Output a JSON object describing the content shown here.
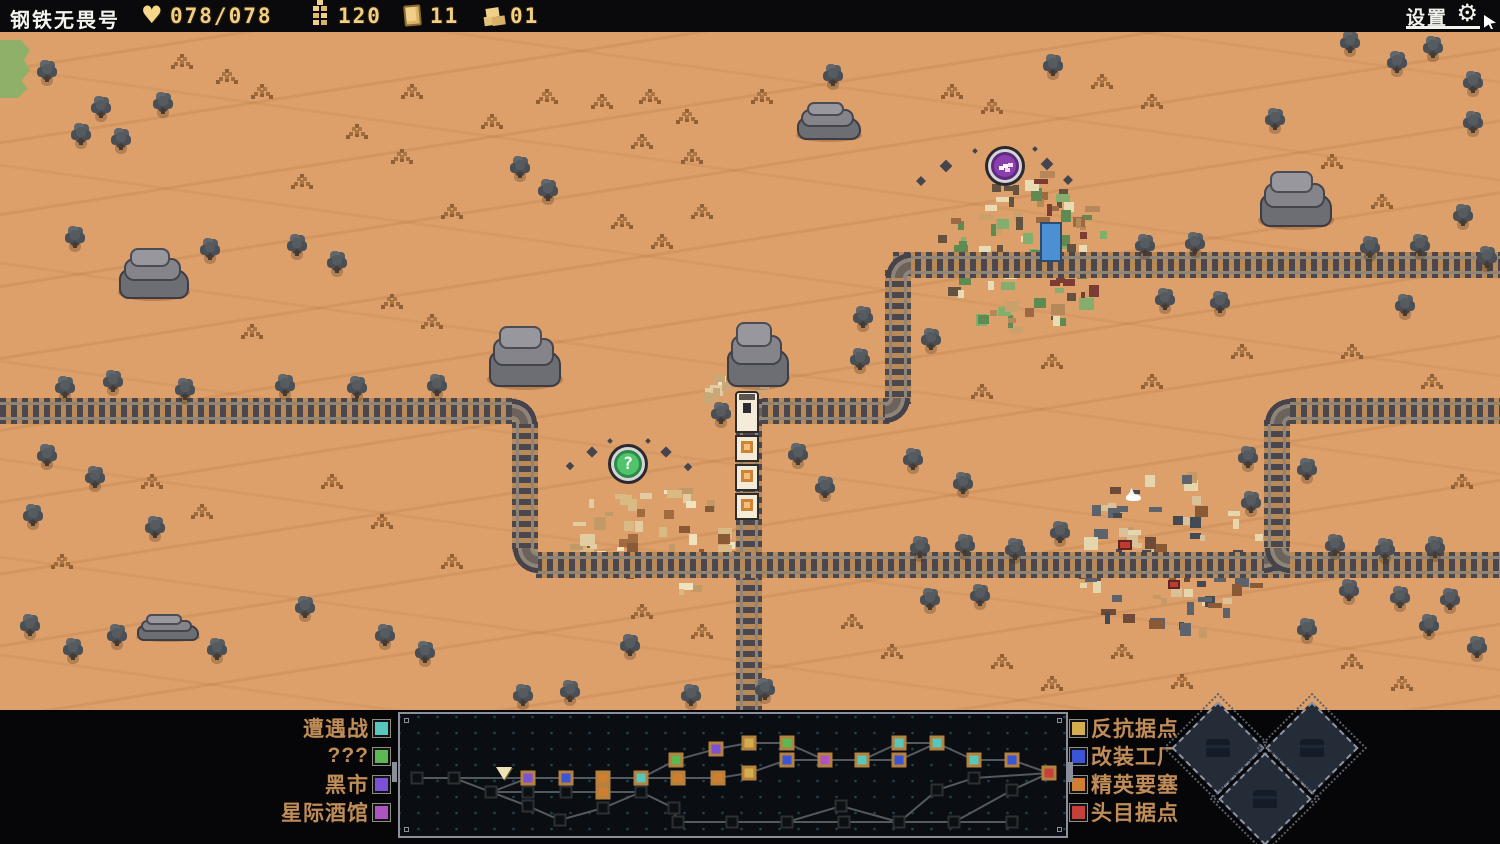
{
  "top_bar": {
    "title": "钢铁无畏号",
    "hp": {
      "icon": "heart-icon",
      "value": "078/078"
    },
    "resources": [
      {
        "icon": "ammo-icon",
        "value": "120"
      },
      {
        "icon": "plate-icon",
        "value": "11"
      },
      {
        "icon": "scrap-icon",
        "value": "01"
      }
    ],
    "settings_label": "设置"
  },
  "map": {
    "green_patch": {
      "x": 0,
      "y": 40,
      "w": 30,
      "h": 58
    },
    "tracks": [
      {
        "dir": "h",
        "x": 893,
        "y": 252,
        "len": 607
      },
      {
        "dir": "v",
        "x": 885,
        "y": 270,
        "len": 134
      },
      {
        "dir": "h",
        "x": 762,
        "y": 398,
        "len": 128
      },
      {
        "dir": "v",
        "x": 736,
        "y": 420,
        "len": 290
      },
      {
        "dir": "h",
        "x": 0,
        "y": 398,
        "len": 516
      },
      {
        "dir": "v",
        "x": 512,
        "y": 422,
        "len": 130
      },
      {
        "dir": "h",
        "x": 536,
        "y": 552,
        "len": 964
      },
      {
        "dir": "v",
        "x": 1264,
        "y": 420,
        "len": 134
      },
      {
        "dir": "h",
        "x": 1290,
        "y": 398,
        "len": 210
      }
    ],
    "corners": [
      {
        "x": 885,
        "y": 252,
        "anchor": "br"
      },
      {
        "x": 885,
        "y": 398,
        "anchor": "tl"
      },
      {
        "x": 736,
        "y": 398,
        "anchor": "br"
      },
      {
        "x": 512,
        "y": 398,
        "anchor": "bl"
      },
      {
        "x": 512,
        "y": 548,
        "anchor": "tr"
      },
      {
        "x": 1264,
        "y": 398,
        "anchor": "br"
      },
      {
        "x": 1264,
        "y": 548,
        "anchor": "tl"
      },
      {
        "x": 1264,
        "y": 548,
        "anchor": "tr"
      }
    ],
    "rocks": [
      {
        "x": 118,
        "y": 243,
        "w": 72,
        "h": 58
      },
      {
        "x": 487,
        "y": 320,
        "w": 76,
        "h": 70
      },
      {
        "x": 726,
        "y": 316,
        "w": 64,
        "h": 74
      },
      {
        "x": 796,
        "y": 98,
        "w": 66,
        "h": 44
      },
      {
        "x": 1258,
        "y": 166,
        "w": 76,
        "h": 64
      },
      {
        "x": 136,
        "y": 612,
        "w": 64,
        "h": 30
      }
    ],
    "bushes": [
      [
        42,
        64
      ],
      [
        96,
        100
      ],
      [
        158,
        96
      ],
      [
        76,
        127
      ],
      [
        116,
        132
      ],
      [
        828,
        68
      ],
      [
        1048,
        58
      ],
      [
        1345,
        35
      ],
      [
        1392,
        55
      ],
      [
        1428,
        40
      ],
      [
        1468,
        75
      ],
      [
        1468,
        115
      ],
      [
        1270,
        112
      ],
      [
        1458,
        208
      ],
      [
        1482,
        250
      ],
      [
        70,
        230
      ],
      [
        205,
        242
      ],
      [
        292,
        238
      ],
      [
        332,
        255
      ],
      [
        515,
        160
      ],
      [
        543,
        183
      ],
      [
        858,
        310
      ],
      [
        855,
        352
      ],
      [
        926,
        332
      ],
      [
        60,
        380
      ],
      [
        108,
        374
      ],
      [
        180,
        382
      ],
      [
        280,
        378
      ],
      [
        352,
        380
      ],
      [
        432,
        378
      ],
      [
        42,
        448
      ],
      [
        90,
        470
      ],
      [
        28,
        508
      ],
      [
        150,
        520
      ],
      [
        716,
        406
      ],
      [
        793,
        447
      ],
      [
        820,
        480
      ],
      [
        908,
        452
      ],
      [
        958,
        476
      ],
      [
        1243,
        450
      ],
      [
        1246,
        495
      ],
      [
        1302,
        462
      ],
      [
        915,
        540
      ],
      [
        960,
        538
      ],
      [
        1010,
        542
      ],
      [
        1330,
        538
      ],
      [
        1380,
        542
      ],
      [
        1430,
        540
      ],
      [
        925,
        592
      ],
      [
        975,
        588
      ],
      [
        1395,
        590
      ],
      [
        1445,
        592
      ],
      [
        1160,
        292
      ],
      [
        1215,
        295
      ],
      [
        1400,
        298
      ],
      [
        1140,
        238
      ],
      [
        1190,
        236
      ],
      [
        1365,
        240
      ],
      [
        1415,
        238
      ],
      [
        25,
        618
      ],
      [
        68,
        642
      ],
      [
        112,
        628
      ],
      [
        212,
        642
      ],
      [
        380,
        628
      ],
      [
        420,
        645
      ],
      [
        518,
        688
      ],
      [
        565,
        684
      ],
      [
        625,
        638
      ],
      [
        686,
        688
      ],
      [
        1302,
        622
      ],
      [
        1344,
        583
      ],
      [
        1424,
        618
      ],
      [
        1472,
        640
      ],
      [
        1055,
        525
      ],
      [
        300,
        600
      ],
      [
        760,
        682
      ]
    ],
    "grass": [
      [
        600,
        100
      ],
      [
        648,
        95
      ],
      [
        685,
        115
      ],
      [
        640,
        140
      ],
      [
        690,
        155
      ],
      [
        225,
        75
      ],
      [
        260,
        90
      ],
      [
        180,
        60
      ],
      [
        760,
        95
      ],
      [
        950,
        90
      ],
      [
        990,
        105
      ],
      [
        1100,
        80
      ],
      [
        1150,
        100
      ],
      [
        355,
        130
      ],
      [
        400,
        155
      ],
      [
        300,
        180
      ],
      [
        450,
        210
      ],
      [
        620,
        220
      ],
      [
        660,
        240
      ],
      [
        700,
        210
      ],
      [
        390,
        300
      ],
      [
        430,
        320
      ],
      [
        250,
        330
      ],
      [
        150,
        480
      ],
      [
        200,
        510
      ],
      [
        60,
        560
      ],
      [
        330,
        480
      ],
      [
        380,
        520
      ],
      [
        450,
        560
      ],
      [
        640,
        610
      ],
      [
        700,
        630
      ],
      [
        850,
        620
      ],
      [
        890,
        650
      ],
      [
        1000,
        660
      ],
      [
        1050,
        682
      ],
      [
        1120,
        650
      ],
      [
        1180,
        680
      ],
      [
        1350,
        660
      ],
      [
        1400,
        682
      ],
      [
        1460,
        480
      ],
      [
        1430,
        380
      ],
      [
        1350,
        350
      ],
      [
        1240,
        350
      ],
      [
        1150,
        380
      ],
      [
        1050,
        360
      ],
      [
        980,
        390
      ],
      [
        1330,
        160
      ],
      [
        1380,
        200
      ],
      [
        1430,
        260
      ],
      [
        545,
        95
      ],
      [
        490,
        120
      ],
      [
        410,
        90
      ]
    ],
    "settlements": [
      {
        "name": "town",
        "x": 935,
        "y": 168,
        "w": 170,
        "h": 160,
        "seed": 7,
        "blocks": 95,
        "palette": [
          "#84ae6d",
          "#5f8a52",
          "#caa06b",
          "#e9dcb4",
          "#7c3c34",
          "#9a6a45",
          "#63523f",
          "#b5885a"
        ]
      },
      {
        "name": "ruins",
        "x": 565,
        "y": 480,
        "w": 165,
        "h": 115,
        "seed": 11,
        "blocks": 60,
        "palette": [
          "#efe2bd",
          "#e2cda2",
          "#d9ba84",
          "#a06b3f",
          "#c29a68",
          "#8a5a36"
        ]
      },
      {
        "name": "outpost",
        "x": 1072,
        "y": 468,
        "w": 190,
        "h": 165,
        "seed": 23,
        "blocks": 90,
        "palette": [
          "#5c636d",
          "#434a54",
          "#c49a66",
          "#8a5a36",
          "#d9c29a",
          "#6e4a38",
          "#e6d6ae"
        ]
      },
      {
        "name": "debris",
        "x": 692,
        "y": 366,
        "w": 74,
        "h": 34,
        "seed": 3,
        "blocks": 14,
        "palette": [
          "#efe2bd",
          "#e2cda2",
          "#c8a878"
        ]
      }
    ],
    "features": [
      {
        "type": "water-tank",
        "x": 1040,
        "y": 222,
        "w": 22,
        "h": 40,
        "color": "#4a90d2"
      },
      {
        "type": "bird",
        "x": 1126,
        "y": 494
      },
      {
        "type": "red-window",
        "x": 1118,
        "y": 540,
        "w": 14,
        "h": 10,
        "color": "#c03a30"
      },
      {
        "type": "red-window",
        "x": 1168,
        "y": 580,
        "w": 12,
        "h": 9,
        "color": "#c03a30"
      }
    ],
    "markers": [
      {
        "name": "black-market-marker",
        "x": 1005,
        "y": 166,
        "fill": "#8b3fae",
        "rim": "#5e2a7e",
        "glyph": "skull",
        "sparkles": [
          [
            946,
            166,
            9
          ],
          [
            921,
            181,
            7
          ],
          [
            1047,
            164,
            9
          ],
          [
            1068,
            180,
            7
          ],
          [
            975,
            151,
            4
          ],
          [
            1035,
            149,
            4
          ]
        ]
      },
      {
        "name": "unknown-marker",
        "x": 628,
        "y": 464,
        "fill": "#4fc46a",
        "rim": "#2e8a46",
        "glyph": "?",
        "sparkles": [
          [
            592,
            452,
            8
          ],
          [
            570,
            466,
            6
          ],
          [
            666,
            452,
            8
          ],
          [
            688,
            467,
            6
          ],
          [
            610,
            441,
            4
          ],
          [
            648,
            441,
            4
          ]
        ]
      }
    ],
    "train": {
      "x": 735,
      "y": 391,
      "w": 24,
      "loco_h": 42,
      "car_h": 27,
      "cars": 3
    }
  },
  "bottom_panel": {
    "legend_left": [
      {
        "label": "遭遇战",
        "color": "#57c6bc"
      },
      {
        "label": "???",
        "color": "#5cb851"
      },
      {
        "label": "黑市",
        "color": "#7b51d8"
      },
      {
        "label": "星际酒馆",
        "color": "#ad54c0"
      }
    ],
    "legend_right": [
      {
        "label": "反抗据点",
        "color": "#d4ae4e"
      },
      {
        "label": "改装工厂",
        "color": "#3c55d6"
      },
      {
        "label": "精英要塞",
        "color": "#cf7f2f"
      },
      {
        "label": "头目据点",
        "color": "#c6403a"
      }
    ],
    "route_map": {
      "panel": {
        "x": 398,
        "y": 712,
        "w": 670,
        "h": 126
      },
      "node_colors": {
        "empty": "#0d1013",
        "encounter": "#57c6bc",
        "unknown": "#5cb851",
        "market": "#7b51d8",
        "tavern": "#ad54c0",
        "resistance": "#d4ae4e",
        "factory": "#3c55d6",
        "elite": "#cf7f2f",
        "boss": "#c6403a"
      },
      "nodes": [
        [
          415,
          776,
          "empty"
        ],
        [
          452,
          776,
          "empty"
        ],
        [
          489,
          790,
          "empty"
        ],
        [
          502,
          776,
          "start"
        ],
        [
          526,
          776,
          "market"
        ],
        [
          526,
          790,
          "empty"
        ],
        [
          526,
          804,
          "empty"
        ],
        [
          564,
          776,
          "factory"
        ],
        [
          564,
          790,
          "empty"
        ],
        [
          558,
          818,
          "empty"
        ],
        [
          601,
          776,
          "elite"
        ],
        [
          601,
          790,
          "elite"
        ],
        [
          601,
          806,
          "empty"
        ],
        [
          639,
          776,
          "encounter"
        ],
        [
          639,
          790,
          "empty"
        ],
        [
          674,
          758,
          "unknown"
        ],
        [
          676,
          776,
          "elite"
        ],
        [
          672,
          806,
          "empty"
        ],
        [
          676,
          820,
          "empty"
        ],
        [
          714,
          747,
          "market"
        ],
        [
          716,
          776,
          "elite"
        ],
        [
          730,
          820,
          "empty"
        ],
        [
          747,
          741,
          "resistance"
        ],
        [
          747,
          771,
          "resistance"
        ],
        [
          785,
          741,
          "unknown"
        ],
        [
          785,
          758,
          "factory"
        ],
        [
          785,
          820,
          "empty"
        ],
        [
          823,
          758,
          "tavern"
        ],
        [
          839,
          804,
          "empty"
        ],
        [
          842,
          820,
          "empty"
        ],
        [
          860,
          758,
          "encounter"
        ],
        [
          897,
          741,
          "encounter"
        ],
        [
          897,
          758,
          "factory"
        ],
        [
          897,
          820,
          "empty"
        ],
        [
          935,
          741,
          "encounter"
        ],
        [
          935,
          788,
          "empty"
        ],
        [
          952,
          820,
          "empty"
        ],
        [
          972,
          758,
          "encounter"
        ],
        [
          972,
          776,
          "empty"
        ],
        [
          1010,
          758,
          "factory"
        ],
        [
          1010,
          788,
          "empty"
        ],
        [
          1010,
          820,
          "empty"
        ],
        [
          1047,
          771,
          "boss"
        ]
      ],
      "edges": [
        [
          0,
          1
        ],
        [
          1,
          3
        ],
        [
          3,
          4
        ],
        [
          4,
          7
        ],
        [
          7,
          10
        ],
        [
          10,
          13
        ],
        [
          13,
          16
        ],
        [
          16,
          20
        ],
        [
          20,
          23
        ],
        [
          1,
          2
        ],
        [
          2,
          4
        ],
        [
          2,
          5
        ],
        [
          5,
          8
        ],
        [
          8,
          11
        ],
        [
          11,
          14
        ],
        [
          2,
          6
        ],
        [
          6,
          9
        ],
        [
          9,
          12
        ],
        [
          12,
          14
        ],
        [
          14,
          17
        ],
        [
          17,
          18
        ],
        [
          18,
          21
        ],
        [
          21,
          26
        ],
        [
          26,
          29
        ],
        [
          29,
          33
        ],
        [
          33,
          36
        ],
        [
          36,
          41
        ],
        [
          13,
          15
        ],
        [
          15,
          19
        ],
        [
          19,
          22
        ],
        [
          22,
          24
        ],
        [
          24,
          27
        ],
        [
          23,
          25
        ],
        [
          25,
          27
        ],
        [
          27,
          30
        ],
        [
          30,
          31
        ],
        [
          31,
          34
        ],
        [
          30,
          32
        ],
        [
          32,
          34
        ],
        [
          34,
          37
        ],
        [
          37,
          39
        ],
        [
          39,
          42
        ],
        [
          26,
          28
        ],
        [
          28,
          33
        ],
        [
          33,
          35
        ],
        [
          35,
          38
        ],
        [
          38,
          42
        ],
        [
          36,
          40
        ],
        [
          40,
          42
        ]
      ],
      "player_node": 3
    },
    "diamond_buttons": [
      {
        "icon": "chest-icon",
        "x": 1218,
        "y": 748
      },
      {
        "icon": "chest-icon",
        "x": 1312,
        "y": 748
      },
      {
        "icon": "chest-icon",
        "x": 1265,
        "y": 799
      }
    ]
  }
}
